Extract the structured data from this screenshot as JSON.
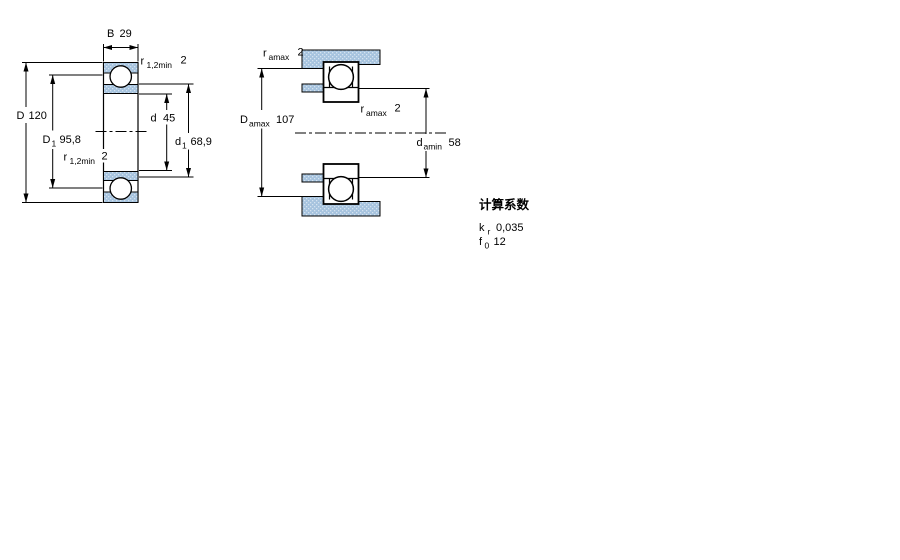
{
  "colors": {
    "section_fill": "#a6c3de",
    "section_fill_dot": "#d5e3f0",
    "line": "#000000",
    "background": "#ffffff"
  },
  "left_diagram": {
    "dims": {
      "B": {
        "label": "B",
        "value": "29"
      },
      "r_top": {
        "label": "r",
        "sub": "1,2min",
        "value": "2"
      },
      "D": {
        "label": "D",
        "value": "120"
      },
      "D1": {
        "label": "D",
        "sub": "1",
        "value": "95,8"
      },
      "r_bottom": {
        "label": "r",
        "sub": "1,2min",
        "value": "2"
      },
      "d": {
        "label": "d",
        "value": "45"
      },
      "d1": {
        "label": "d",
        "sub": "1",
        "value": "68,9"
      }
    }
  },
  "right_diagram": {
    "dims": {
      "r_amax_top": {
        "label": "r",
        "sub": "amax",
        "value": "2"
      },
      "D_amax": {
        "label": "D",
        "sub": "amax",
        "value": "107"
      },
      "r_amax_mid": {
        "label": "r",
        "sub": "amax",
        "value": "2"
      },
      "d_amin": {
        "label": "d",
        "sub": "amin",
        "value": "58"
      }
    }
  },
  "calculation_factors": {
    "heading": "计算系数",
    "factors": [
      {
        "label": "k",
        "sub": "r",
        "value": "0,035"
      },
      {
        "label": "f",
        "sub": "0",
        "value": "12"
      }
    ]
  }
}
